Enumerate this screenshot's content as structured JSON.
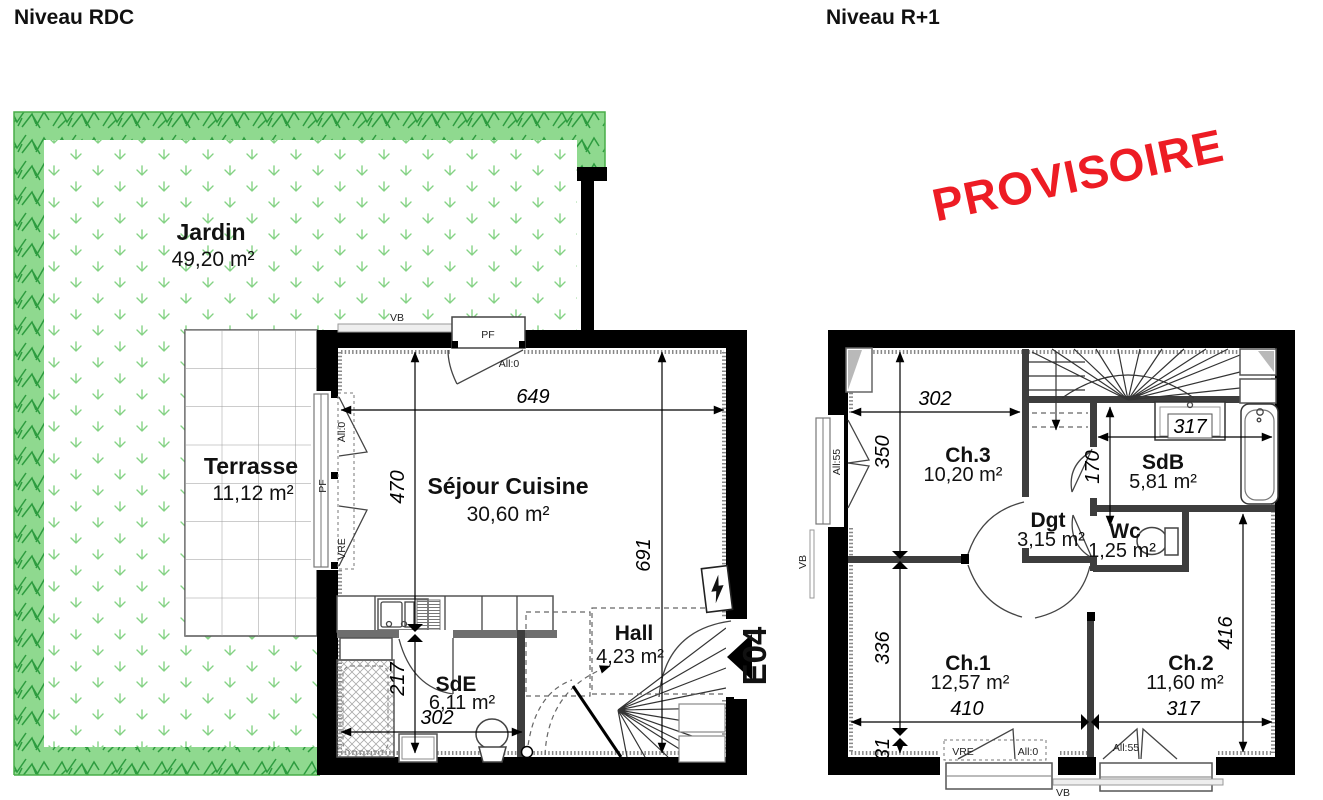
{
  "stamp": {
    "text": "PROVISOIRE",
    "color": "#ed1c24"
  },
  "rdc": {
    "title": "Niveau RDC",
    "entrance_label": "E04",
    "rooms": {
      "jardin": {
        "label": "Jardin",
        "area": "49,20 m²"
      },
      "terrasse": {
        "label": "Terrasse",
        "area": "11,12 m²"
      },
      "sejour": {
        "label": "Séjour Cuisine",
        "area": "30,60 m²"
      },
      "hall": {
        "label": "Hall",
        "area": "4,23 m²"
      },
      "sde": {
        "label": "SdE",
        "area": "6,11 m²"
      }
    },
    "dims": {
      "top_width": "649",
      "sejour_height": "470",
      "right_height": "691",
      "sde_height": "217",
      "sde_width": "302"
    },
    "openings": {
      "vb_top": "VB",
      "pf_top": "PF",
      "pf_top_all": "All:0",
      "left_all": "All:0",
      "left_pf": "PF",
      "left_vre": "VRE"
    }
  },
  "r1": {
    "title": "Niveau R+1",
    "rooms": {
      "ch3": {
        "label": "Ch.3",
        "area": "10,20 m²"
      },
      "sdb": {
        "label": "SdB",
        "area": "5,81 m²"
      },
      "dgt": {
        "label": "Dgt",
        "area": "3,15 m²"
      },
      "wc": {
        "label": "Wc",
        "area": "1,25 m²"
      },
      "ch1": {
        "label": "Ch.1",
        "area": "12,57 m²"
      },
      "ch2": {
        "label": "Ch.2",
        "area": "11,60 m²"
      }
    },
    "dims": {
      "ch3_width": "302",
      "ch3_height": "350",
      "sdb_width": "317",
      "sdb_height": "170",
      "ch1_height": "336",
      "ch1_bottom": "31",
      "ch1_width": "410",
      "ch2_width": "317",
      "ch2_height": "416"
    },
    "openings": {
      "left_all": "All:55",
      "left_vb": "VB",
      "ch1_vre": "VRE",
      "ch1_all": "All:0",
      "ch2_all": "All:55",
      "vb_bottom": "VB"
    }
  }
}
